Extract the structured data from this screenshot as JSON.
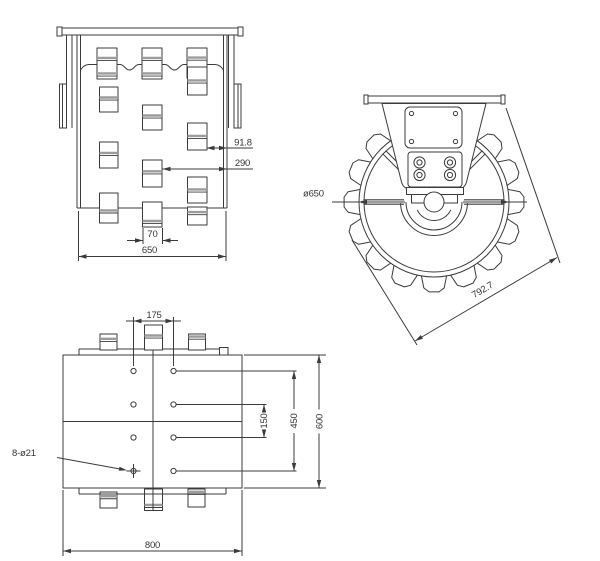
{
  "drawing": {
    "views": {
      "front": {
        "dims": {
          "offset_small": "91.8",
          "offset_large": "290",
          "pad_width": "70",
          "drum_width": "650"
        }
      },
      "side": {
        "dims": {
          "diameter": "ø650",
          "diagonal": "792.7"
        }
      },
      "top": {
        "dims": {
          "hole_cols_spacing": "175",
          "hole_rows_pitch": "150",
          "hole_rows_span": "450",
          "plate_depth": "600",
          "plate_width": "800",
          "holes_note": "8-ø21"
        }
      }
    }
  }
}
